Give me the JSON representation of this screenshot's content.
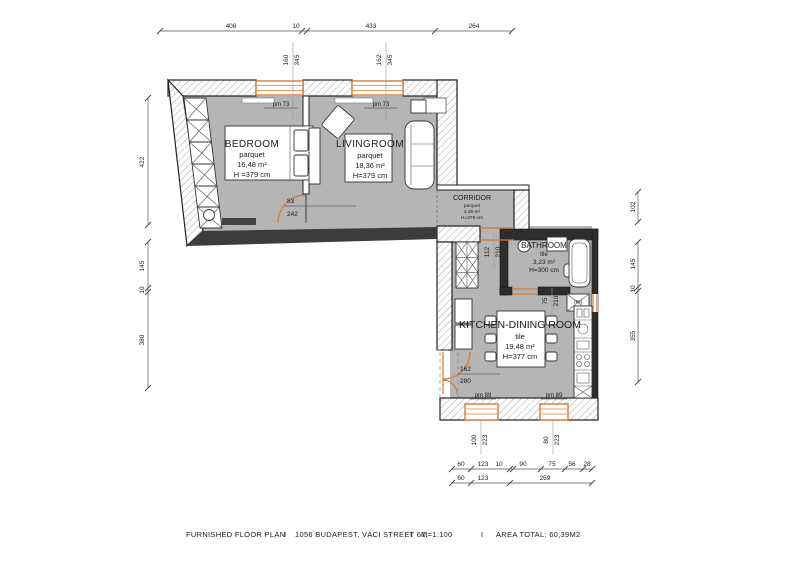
{
  "plan": {
    "footer_parts": [
      "FURNISHED FLOOR PLAN",
      "I",
      "1056 BUDAPEST, VÁCI STREET 67.",
      "I",
      "M=1:100",
      "I",
      "AREA TOTAL: 60,39M2"
    ]
  },
  "rooms": {
    "bedroom": {
      "name": "BEDROOM",
      "floor": "parquet",
      "area": "16,48 m²",
      "height": "H =379 cm"
    },
    "livingroom": {
      "name": "LIVINGROOM",
      "floor": "parquet",
      "area": "18,36 m²",
      "height": "H=379 cm"
    },
    "corridor": {
      "name": "CORRIDOR",
      "floor": "parquet",
      "area": "3,36 m²",
      "height": "H=379 cm"
    },
    "bathroom": {
      "name": "BATHROOM",
      "floor": "tile",
      "area": "3,23 m²",
      "height": "H=300 cm"
    },
    "kitchen": {
      "name": "KITCHEN-DINING ROOM",
      "floor": "tile",
      "area": "19,48 m²",
      "height": "H=377 cm"
    }
  },
  "dims": {
    "top": [
      "408",
      "10",
      "433",
      "264"
    ],
    "left": [
      "422",
      "145",
      "10",
      "380"
    ],
    "right": [
      "102",
      "145",
      "10",
      "355"
    ],
    "bottom1": [
      "60",
      "123",
      "10",
      "90",
      "75",
      "56",
      "28"
    ],
    "bottom2": [
      "60",
      "123",
      "259"
    ]
  },
  "openings": {
    "bedroom_window": {
      "w": "160",
      "h": "345",
      "parapet": "pm 73"
    },
    "livingroom_window": {
      "w": "162",
      "h": "345",
      "parapet": "pm 73"
    },
    "bedroom_door": {
      "w": "83",
      "h": "242"
    },
    "corridor_kitchen_door": {
      "w": "112",
      "h": "210"
    },
    "bathroom_door": {
      "w": "75",
      "h": "210"
    },
    "balcony_door": {
      "w": "162",
      "h": "280"
    },
    "kitchen_window_left": {
      "w": "100",
      "h": "223",
      "parapet": "pm 89"
    },
    "kitchen_window_right": {
      "w": "80",
      "h": "223",
      "parapet": "pm 89"
    },
    "entrance_door": {
      "label": "(90)"
    }
  },
  "colors": {
    "floor": "#b5b5b5",
    "window_accent": "#d9782f",
    "wall_dark": "#2d2d2d"
  }
}
